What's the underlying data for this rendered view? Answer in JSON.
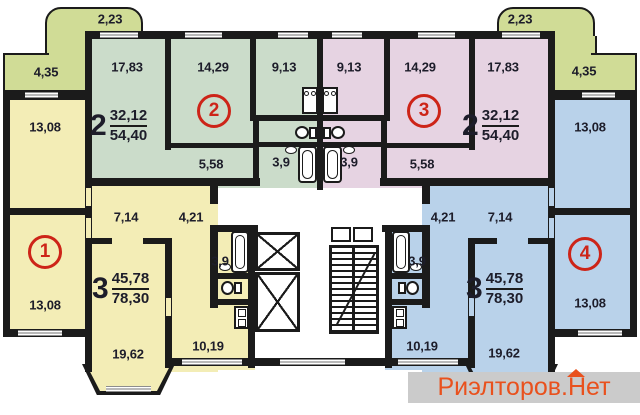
{
  "document": {
    "type": "apartment-floor-plan",
    "watermark": {
      "text": "Риэлторов.Нет"
    }
  },
  "balconies": {
    "top_left": "2,23",
    "top_right": "2,23",
    "side_left": "4,35",
    "side_right": "4,35"
  },
  "apartments": [
    {
      "number": "1",
      "rooms_count": "3",
      "living_area": "45,78",
      "total_area": "78,30",
      "rooms": {
        "bedroom_top": "13,08",
        "bedroom_bottom": "13,08",
        "living_room": "19,62",
        "kitchen": "10,19",
        "bath": "3,9",
        "hall_a": "7,14",
        "hall_b": "4,21"
      }
    },
    {
      "number": "2",
      "rooms_count": "2",
      "living_area": "32,12",
      "total_area": "54,40",
      "rooms": {
        "room_large": "17,83",
        "room_small": "14,29",
        "kitchen": "9,13",
        "hall": "5,58",
        "bath": "3,9"
      }
    },
    {
      "number": "3",
      "rooms_count": "2",
      "living_area": "32,12",
      "total_area": "54,40",
      "rooms": {
        "room_large": "17,83",
        "room_small": "14,29",
        "kitchen": "9,13",
        "hall": "5,58",
        "bath": "3,9"
      }
    },
    {
      "number": "4",
      "rooms_count": "3",
      "living_area": "45,78",
      "total_area": "78,30",
      "rooms": {
        "bedroom_top": "13,08",
        "bedroom_bottom": "13,08",
        "living_room": "19,62",
        "kitchen": "10,19",
        "bath": "3,9",
        "hall_a": "7,14",
        "hall_b": "4,21"
      }
    }
  ],
  "colors": {
    "apartment_1": "#f3edb6",
    "apartment_2": "#cbdcca",
    "apartment_3": "#e6d3e2",
    "apartment_4": "#b9d2ea",
    "balcony": "#d0dc96",
    "walls": "#1b1b1b",
    "badge_red": "#cd2418",
    "watermark_bg": "#cbcbcb",
    "watermark_text": "#e9511d"
  }
}
